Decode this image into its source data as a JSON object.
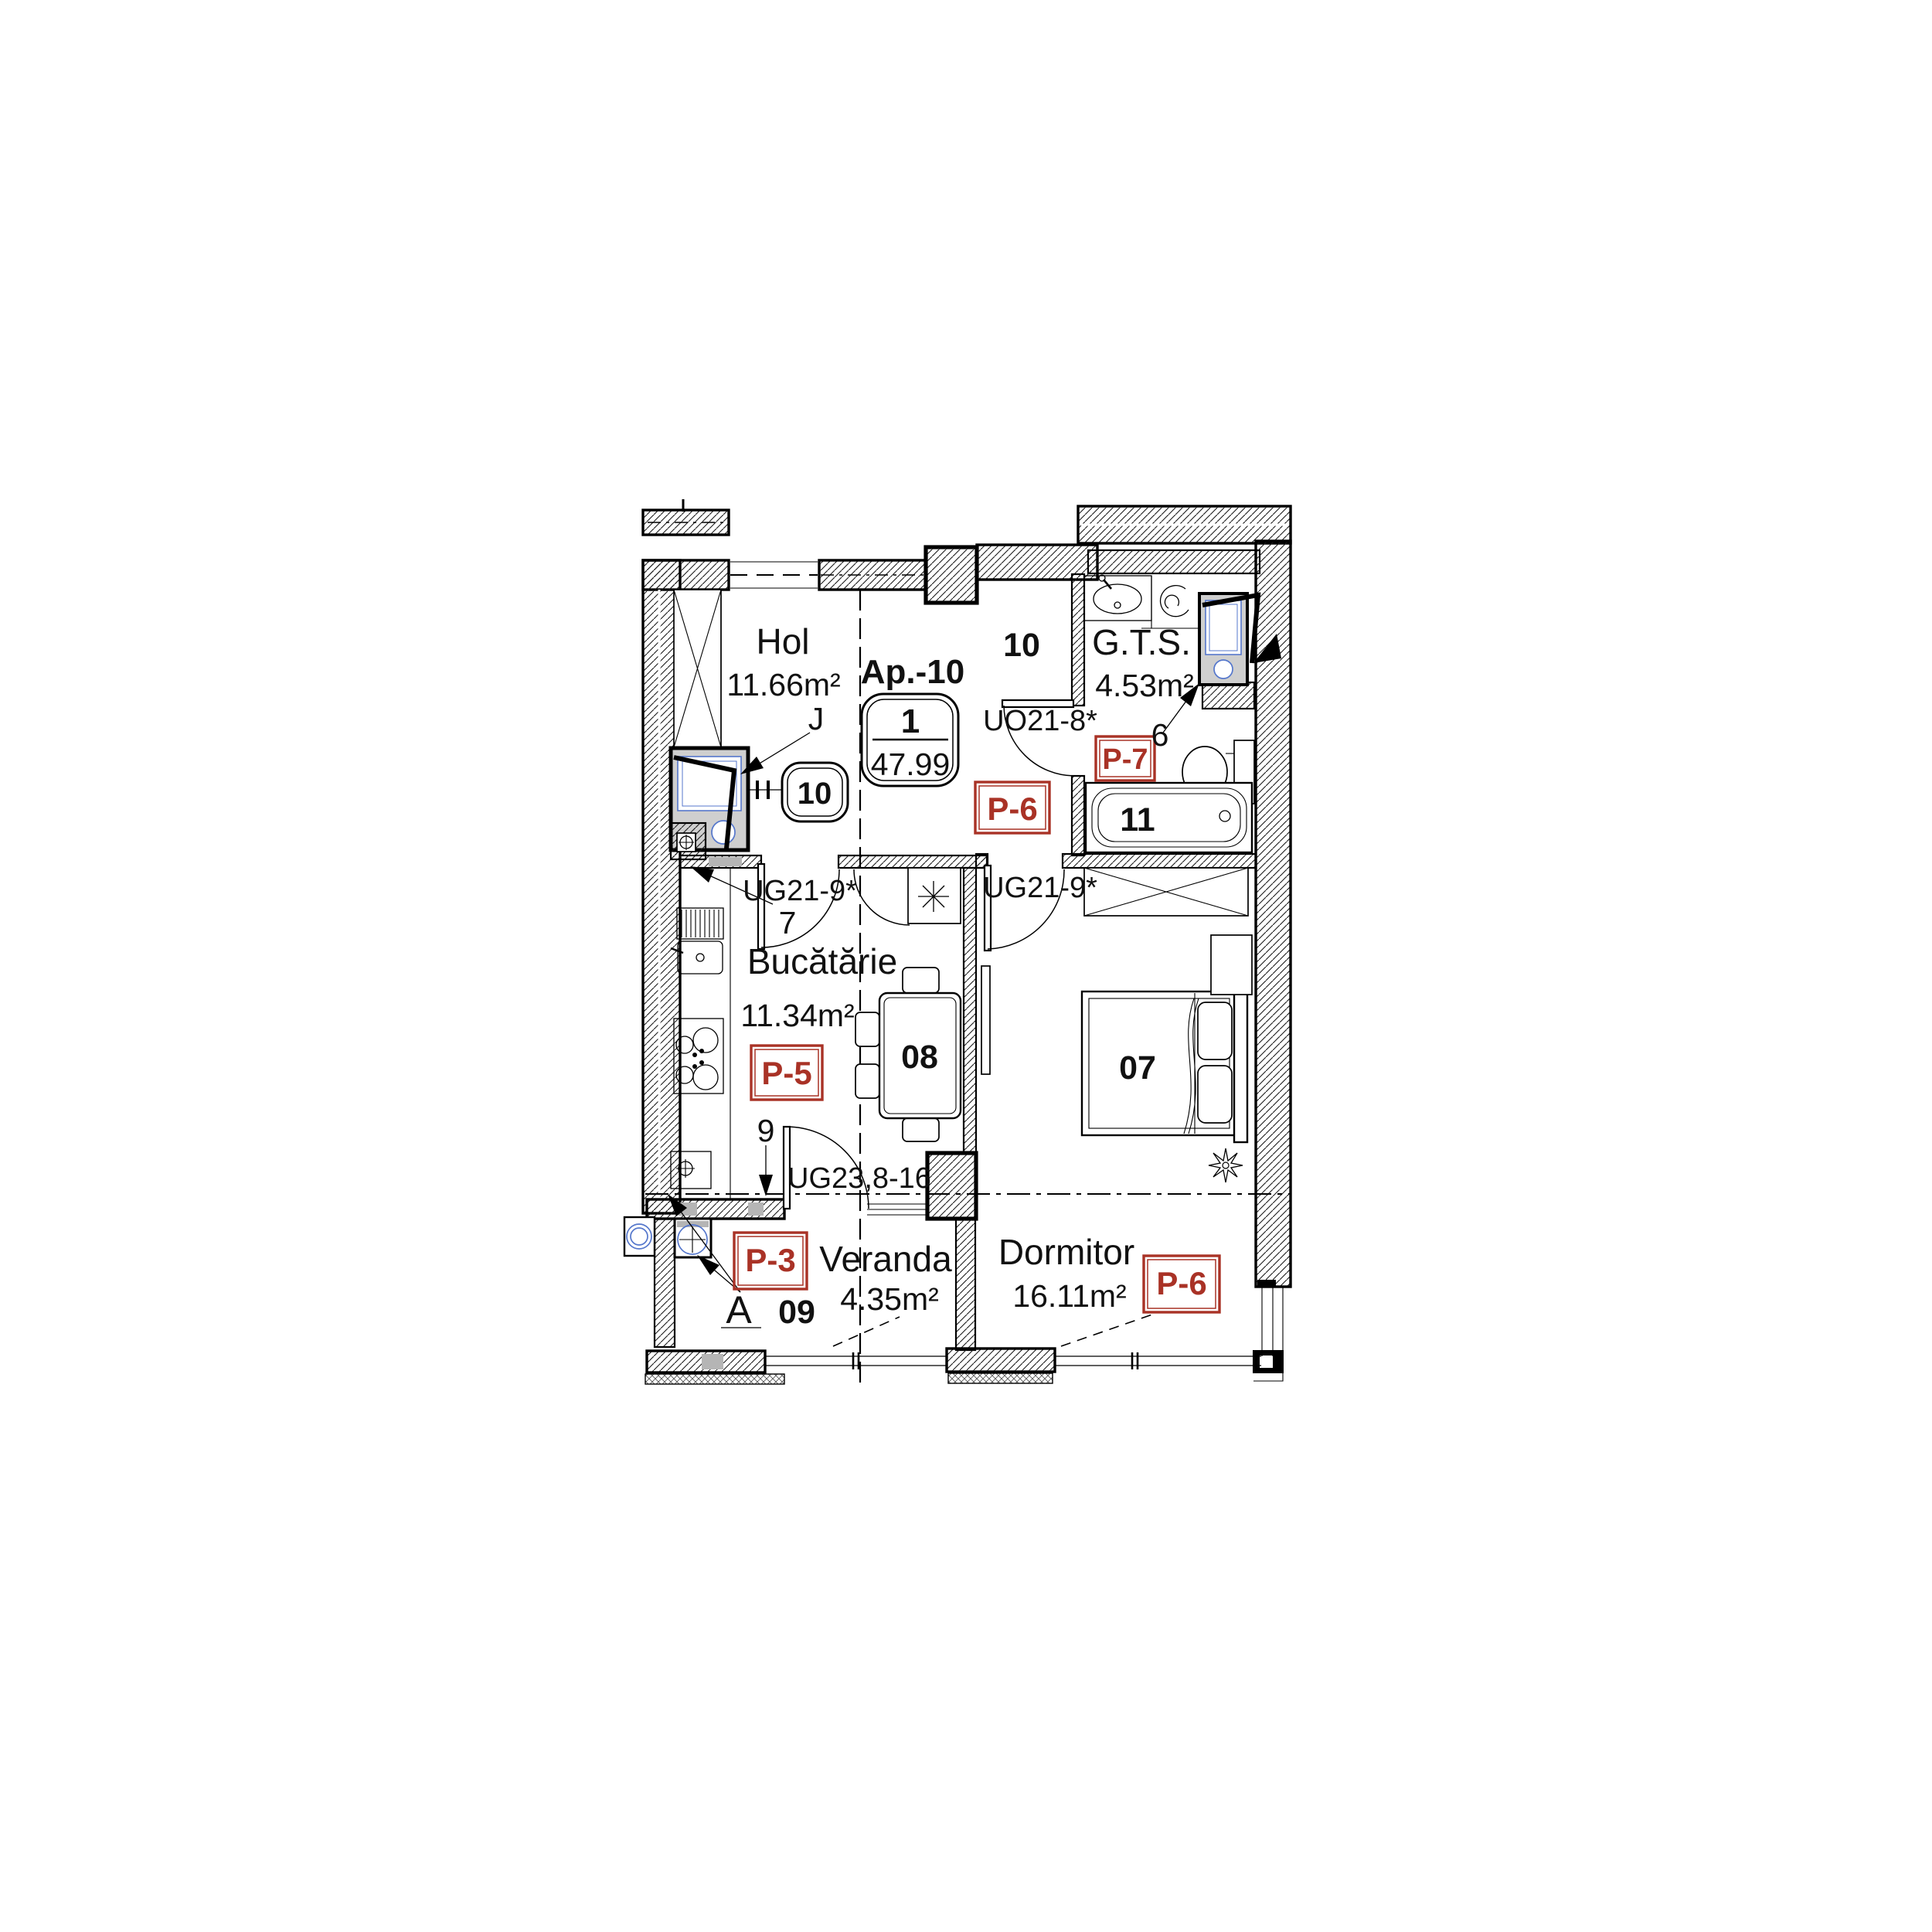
{
  "colors": {
    "finish_tag_red": "#A93226",
    "fixture_blue": "#5577cc",
    "wall_line": "#000000",
    "insulation_grey": "#b5b5b5",
    "shaft_grey": "#cfcfcf"
  },
  "apartment": {
    "tag_title": "Ap.-10",
    "unit_number": "1",
    "total_area": "47.99"
  },
  "rooms": {
    "hol": {
      "name": "Hol",
      "area": "11.66m²",
      "closet_tag": "J",
      "shaft_tag_number": "10"
    },
    "vestibule": {
      "zone_number": "10",
      "finish_tag": "P-6"
    },
    "gts": {
      "name": "G.T.S.",
      "area": "4.53m²",
      "door_code": "UO21-8*",
      "shaft_number": "6",
      "finish_tag": "P-7",
      "bathtub_number": "11"
    },
    "kitchen": {
      "name": "Bucătărie",
      "area": "11.34m²",
      "finish_tag": "P-5",
      "hall_door_code": "UG21-9*",
      "hall_door_number": "7",
      "balcony_door_number": "9",
      "balcony_door_code": "UG23,8-16",
      "table_number": "08"
    },
    "bedroom": {
      "name": "Dormitor",
      "area": "16.11m²",
      "finish_tag": "P-6",
      "door_code": "UG21-9*",
      "bed_number": "07"
    },
    "veranda": {
      "name": "Veranda",
      "area": "4.35m²",
      "finish_tag": "P-3",
      "zone_number": "09",
      "axis_label": "A"
    }
  }
}
